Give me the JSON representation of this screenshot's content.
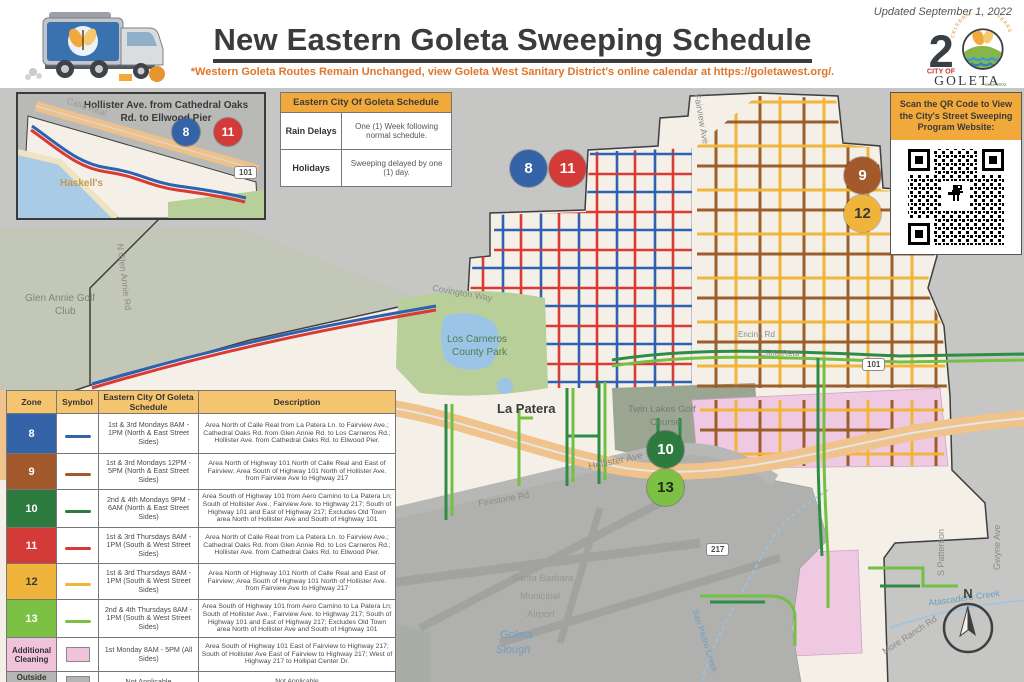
{
  "header": {
    "updated": "Updated September 1, 2022",
    "title": "New Eastern Goleta Sweeping Schedule",
    "subtitle": "*Western Goleta Routes Remain Unchanged, view Goleta West Sanitary District's online calendar at https://goletawest.org/.",
    "logo": {
      "celebrating": "CELEBRATING 20 YEARS",
      "number": "2",
      "city_of": "CITY OF",
      "name": "GOLETA",
      "since": "since 2002"
    }
  },
  "inset": {
    "title": "Hollister Ave. from Cathedral Oaks Rd. to Ellwood Pier",
    "labels": {
      "calle_real": "Calle Real",
      "haskells": "Haskell's",
      "shield": "101"
    },
    "badges": [
      {
        "zone": "8"
      },
      {
        "zone": "11"
      }
    ]
  },
  "schedule_table": {
    "title": "Eastern City Of Goleta Schedule",
    "rows": [
      {
        "label": "Rain Delays",
        "value": "One (1) Week following normal schedule."
      },
      {
        "label": "Holidays",
        "value": "Sweeping delayed by one (1) day."
      }
    ]
  },
  "qr_box": {
    "title": "Scan the QR Code to View the City's Street Sweeping Program Website:"
  },
  "legend": {
    "headers": [
      "Zone",
      "Symbol",
      "Eastern City Of Goleta Schedule",
      "Description"
    ],
    "rows": [
      {
        "zone": "8",
        "color": "#3563a8",
        "schedule": "1st & 3rd Mondays 8AM - 1PM (North & East Street Sides)",
        "description": "Area North of Calle Real from La Patera Ln. to Fairview Ave.; Cathedral Oaks Rd. from Glen Annie Rd. to Los Carneros Rd.; Hollister Ave. from Cathedral Oaks Rd. to Ellwood Pier."
      },
      {
        "zone": "9",
        "color": "#a2592b",
        "schedule": "1st & 3rd Mondays 12PM - 5PM (North & East Street Sides)",
        "description": "Area North of Highway 101 North of Calle Real and East of Fairview; Area South of Highway 101 North of Hollister Ave. from Fairview Ave to Highway 217"
      },
      {
        "zone": "10",
        "color": "#2e7b3f",
        "schedule": "2nd & 4th Mondays 9PM - 6AM (North & East Street Sides)",
        "description": "Area South of Highway 101 from Aero Camino to La Patera Ln; South of Hollister Ave.; Fairview Ave. to Highway 217; South of Highway 101 and East of Highway 217; Excludes Old Town area North of Hollister Ave and South of Highway 101"
      },
      {
        "zone": "11",
        "color": "#d43a38",
        "schedule": "1st & 3rd Thursdays 8AM - 1PM (South & West Street Sides)",
        "description": "Area North of Calle Real from La Patera Ln. to Fairview Ave.; Cathedral Oaks Rd. from Glen Annie Rd. to Los Carneros Rd.; Hollister Ave. from Cathedral Oaks Rd. to Ellwood Pier."
      },
      {
        "zone": "12",
        "color": "#f0b43a",
        "schedule": "1st & 3rd Thursdays 8AM - 1PM (South & West Street Sides)",
        "description": "Area North of Highway 101 North of Calle Real and East of Fairview; Area South of Highway 101 North of Hollister Ave. from Fairview Ave to Highway 217"
      },
      {
        "zone": "13",
        "color": "#7cc143",
        "schedule": "2nd & 4th Thursdays 8AM - 1PM (South & West Street Sides)",
        "description": "Area South of Highway 101 from Aero Camino to La Patera Ln; South of Hollister Ave.; Fairview Ave. to Highway 217; South of Highway 101 and East of Highway 217; Excludes Old Town area North of Hollister Ave and South of Highway 101"
      },
      {
        "zone": "Additional Cleaning",
        "color": "#f0c3da",
        "schedule": "1st Monday 8AM - 5PM (All Sides)",
        "description": "Area South of Highway 101 East of Fairview to Highway 217; South of Hollister Ave East of Fairview to Highway 217; West of Highway 217 to Hollipat Center Dr."
      },
      {
        "zone": "Outside City Limits",
        "color": "#b5b5b3",
        "schedule": "Not Applicable",
        "description": "Not Applicable"
      }
    ]
  },
  "map": {
    "badges": [
      {
        "zone": "8",
        "color": "#3563a8"
      },
      {
        "zone": "11",
        "color": "#d43a38"
      },
      {
        "zone": "9",
        "color": "#a2592b"
      },
      {
        "zone": "12",
        "color": "#f0b43a"
      },
      {
        "zone": "10",
        "color": "#2e7b3f"
      },
      {
        "zone": "13",
        "color": "#7cc143"
      }
    ],
    "shields": [
      {
        "text": "101"
      },
      {
        "text": "217"
      }
    ],
    "compass": "N",
    "labels": [
      {
        "text": "Covington Way"
      },
      {
        "text": "Los Carneros"
      },
      {
        "text": "County Park"
      },
      {
        "text": "Glen Annie Golf"
      },
      {
        "text": "Club"
      },
      {
        "text": "N Glen Annie Rd"
      },
      {
        "text": "La Patera"
      },
      {
        "text": "Twin Lakes Golf"
      },
      {
        "text": "Course"
      },
      {
        "text": "Hollister Ave"
      },
      {
        "text": "Firestone Rd"
      },
      {
        "text": "Hollister Ave"
      },
      {
        "text": "Santa Barbara"
      },
      {
        "text": "Municipal"
      },
      {
        "text": "Airport"
      },
      {
        "text": "Goleta"
      },
      {
        "text": "Slough"
      },
      {
        "text": "Atascadero Creek"
      },
      {
        "text": "S Patterson"
      },
      {
        "text": "Gwyne Ave"
      },
      {
        "text": "More Ranch Rd"
      },
      {
        "text": "San Pedro Creek"
      },
      {
        "text": "Fairview Ave"
      },
      {
        "text": "Calle Real"
      },
      {
        "text": "Encina Rd"
      }
    ]
  },
  "colors": {
    "accent_orange": "#f2a93b",
    "subtitle_orange": "#e0752b",
    "title_gray": "#3b3b3b",
    "highway_tan": "#f0c28c",
    "map_outside_gray": "#c6c6c4",
    "map_city_cream": "#f4f0e8",
    "additional_pink": "#eec9e1",
    "route_blue": "#2e62b1",
    "route_red": "#d93a33",
    "route_brown": "#9c5f2b",
    "route_yellow": "#f2b53c",
    "route_dark_green": "#2f8c46",
    "route_light_green": "#74c043"
  }
}
